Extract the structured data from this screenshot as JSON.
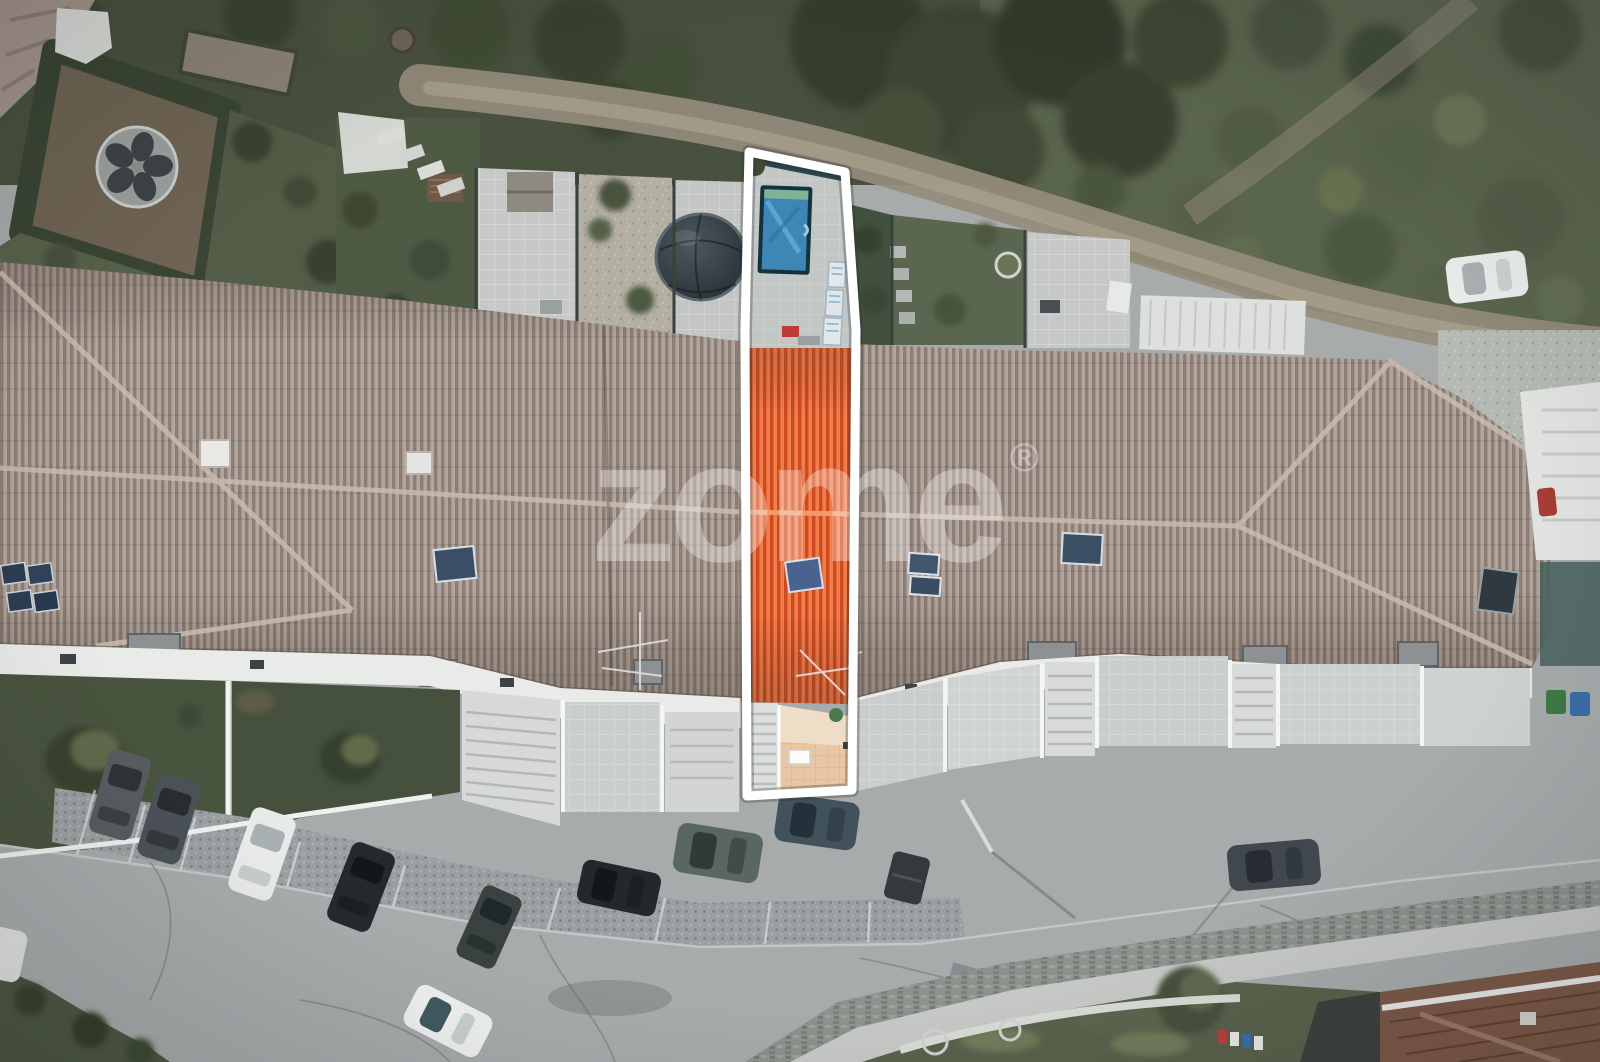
{
  "image": {
    "kind": "aerial-drone-photograph",
    "subject": "Top-down view of a row of terraced houses; one unit highlighted in orange with a white outline for a real-estate listing",
    "orientation": "top-down"
  },
  "watermark": {
    "brand": "zome",
    "registered_mark": "®",
    "color": "#ffffff",
    "opacity": "0.33"
  },
  "highlighted_property": {
    "outline_color": "#ffffff",
    "roof_color_light": "#ef7e4b",
    "roof_color_dark": "#cf4a20",
    "pool_cover_color": "#3e86b6",
    "terrace_tile_color": "#eccaa9"
  },
  "palette": {
    "neighbour_roof_light": "#b2a59b",
    "neighbour_roof_dark": "#8c7e76",
    "vegetation_dark": "#39412f",
    "vegetation_scrub": "#5a654e",
    "dirt_path": "#9a9183",
    "asphalt": "#a7abac",
    "cobble_parking": "#9da1a2",
    "facade_white": "#eceeec",
    "lawn_green": "#49543f",
    "stone_wall": "#8e928f",
    "bottom_right_roof": "#7c5948"
  },
  "objects": {
    "parked_cars": 9,
    "moving_cars": 1,
    "distant_parked_car": 1,
    "partial_car_left_edge": 1,
    "solar_panel_installations": 6,
    "skylights": 2,
    "chimneys": 6,
    "covered_pool": 1,
    "garden_dome_tent": 1,
    "trampoline_dome": 1,
    "dumpster": 1
  }
}
